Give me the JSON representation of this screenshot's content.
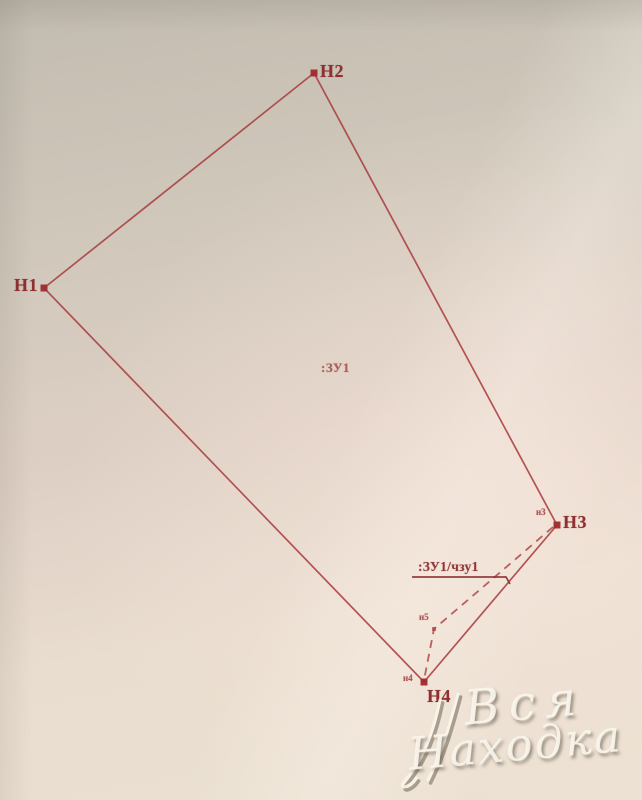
{
  "scheme": {
    "parcel_label": ":ЗУ1",
    "part_label": ":ЗУ1/чзу1",
    "points": {
      "h1": "Н1",
      "h2": "Н2",
      "h3": "Н3",
      "h4": "Н4"
    },
    "minor_points": {
      "n3": "н3",
      "n4": "н4",
      "n5": "н5"
    },
    "colors": {
      "boundary_line": "#a8393c",
      "point_marker": "#9f2b2e",
      "point_label": "#8e2f31",
      "paper": "#e6dbcc"
    }
  },
  "watermark": {
    "word1": "Вся",
    "word2": "Находка"
  }
}
